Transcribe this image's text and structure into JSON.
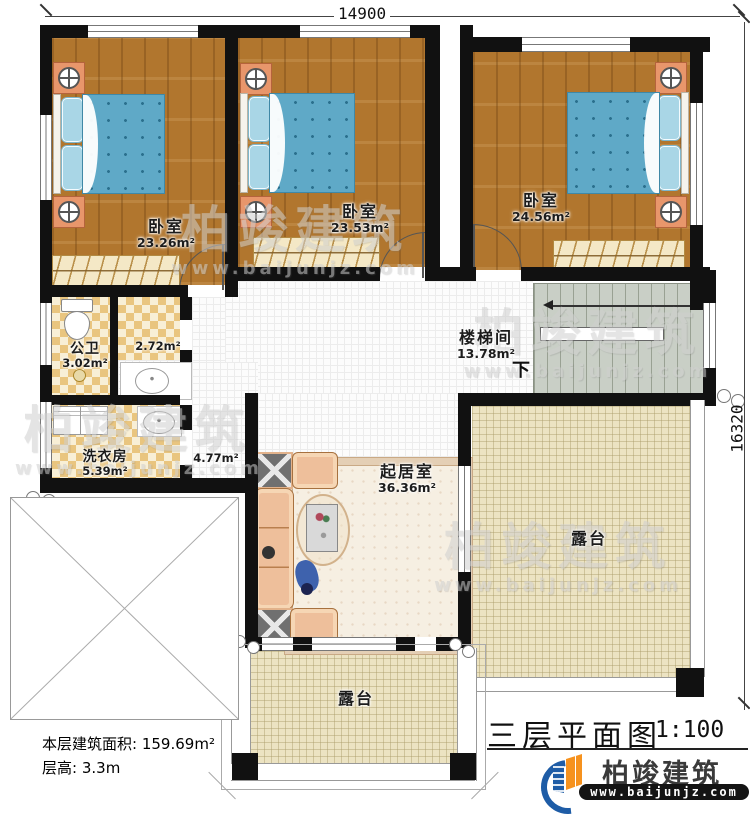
{
  "plan": {
    "title": "三层平面图",
    "scale": "1:100",
    "floor_area_label": "本层建筑面积:",
    "floor_area_value": "159.69m²",
    "floor_height_label": "层高:",
    "floor_height_value": "3.3m"
  },
  "dimensions": {
    "top": "14900",
    "right": "16320"
  },
  "rooms": {
    "bedroom1": {
      "name": "卧室",
      "area": "23.26m²"
    },
    "bedroom2": {
      "name": "卧室",
      "area": "23.53m²"
    },
    "bedroom3": {
      "name": "卧室",
      "area": "24.56m²"
    },
    "bathroom": {
      "name": "公卫",
      "area": "3.02m²"
    },
    "closet": {
      "area": "2.72m²"
    },
    "laundry": {
      "name": "洗衣房",
      "area": "5.39m²"
    },
    "corridor": {
      "area": "4.77m²"
    },
    "stairwell": {
      "name": "楼梯间",
      "area": "13.78m²",
      "down": "下"
    },
    "living": {
      "name": "起居室",
      "area": "36.36m²"
    },
    "terrace_right": {
      "name": "露台"
    },
    "terrace_bottom": {
      "name": "露台"
    }
  },
  "brand": {
    "name": "柏竣建筑",
    "url": "www.baijunjz.com"
  },
  "watermark": {
    "line1": "柏竣建筑",
    "line2": "www.baijunjz.com"
  },
  "colors": {
    "wall": "#111111",
    "wood": "#b1762e",
    "bed": "#5fa9c7",
    "tile": "#e9c57f",
    "terrace": "#ece3c2",
    "stair": "#c9cfc6",
    "logo_blue": "#1e5ca6",
    "logo_orange": "#f6921e"
  }
}
